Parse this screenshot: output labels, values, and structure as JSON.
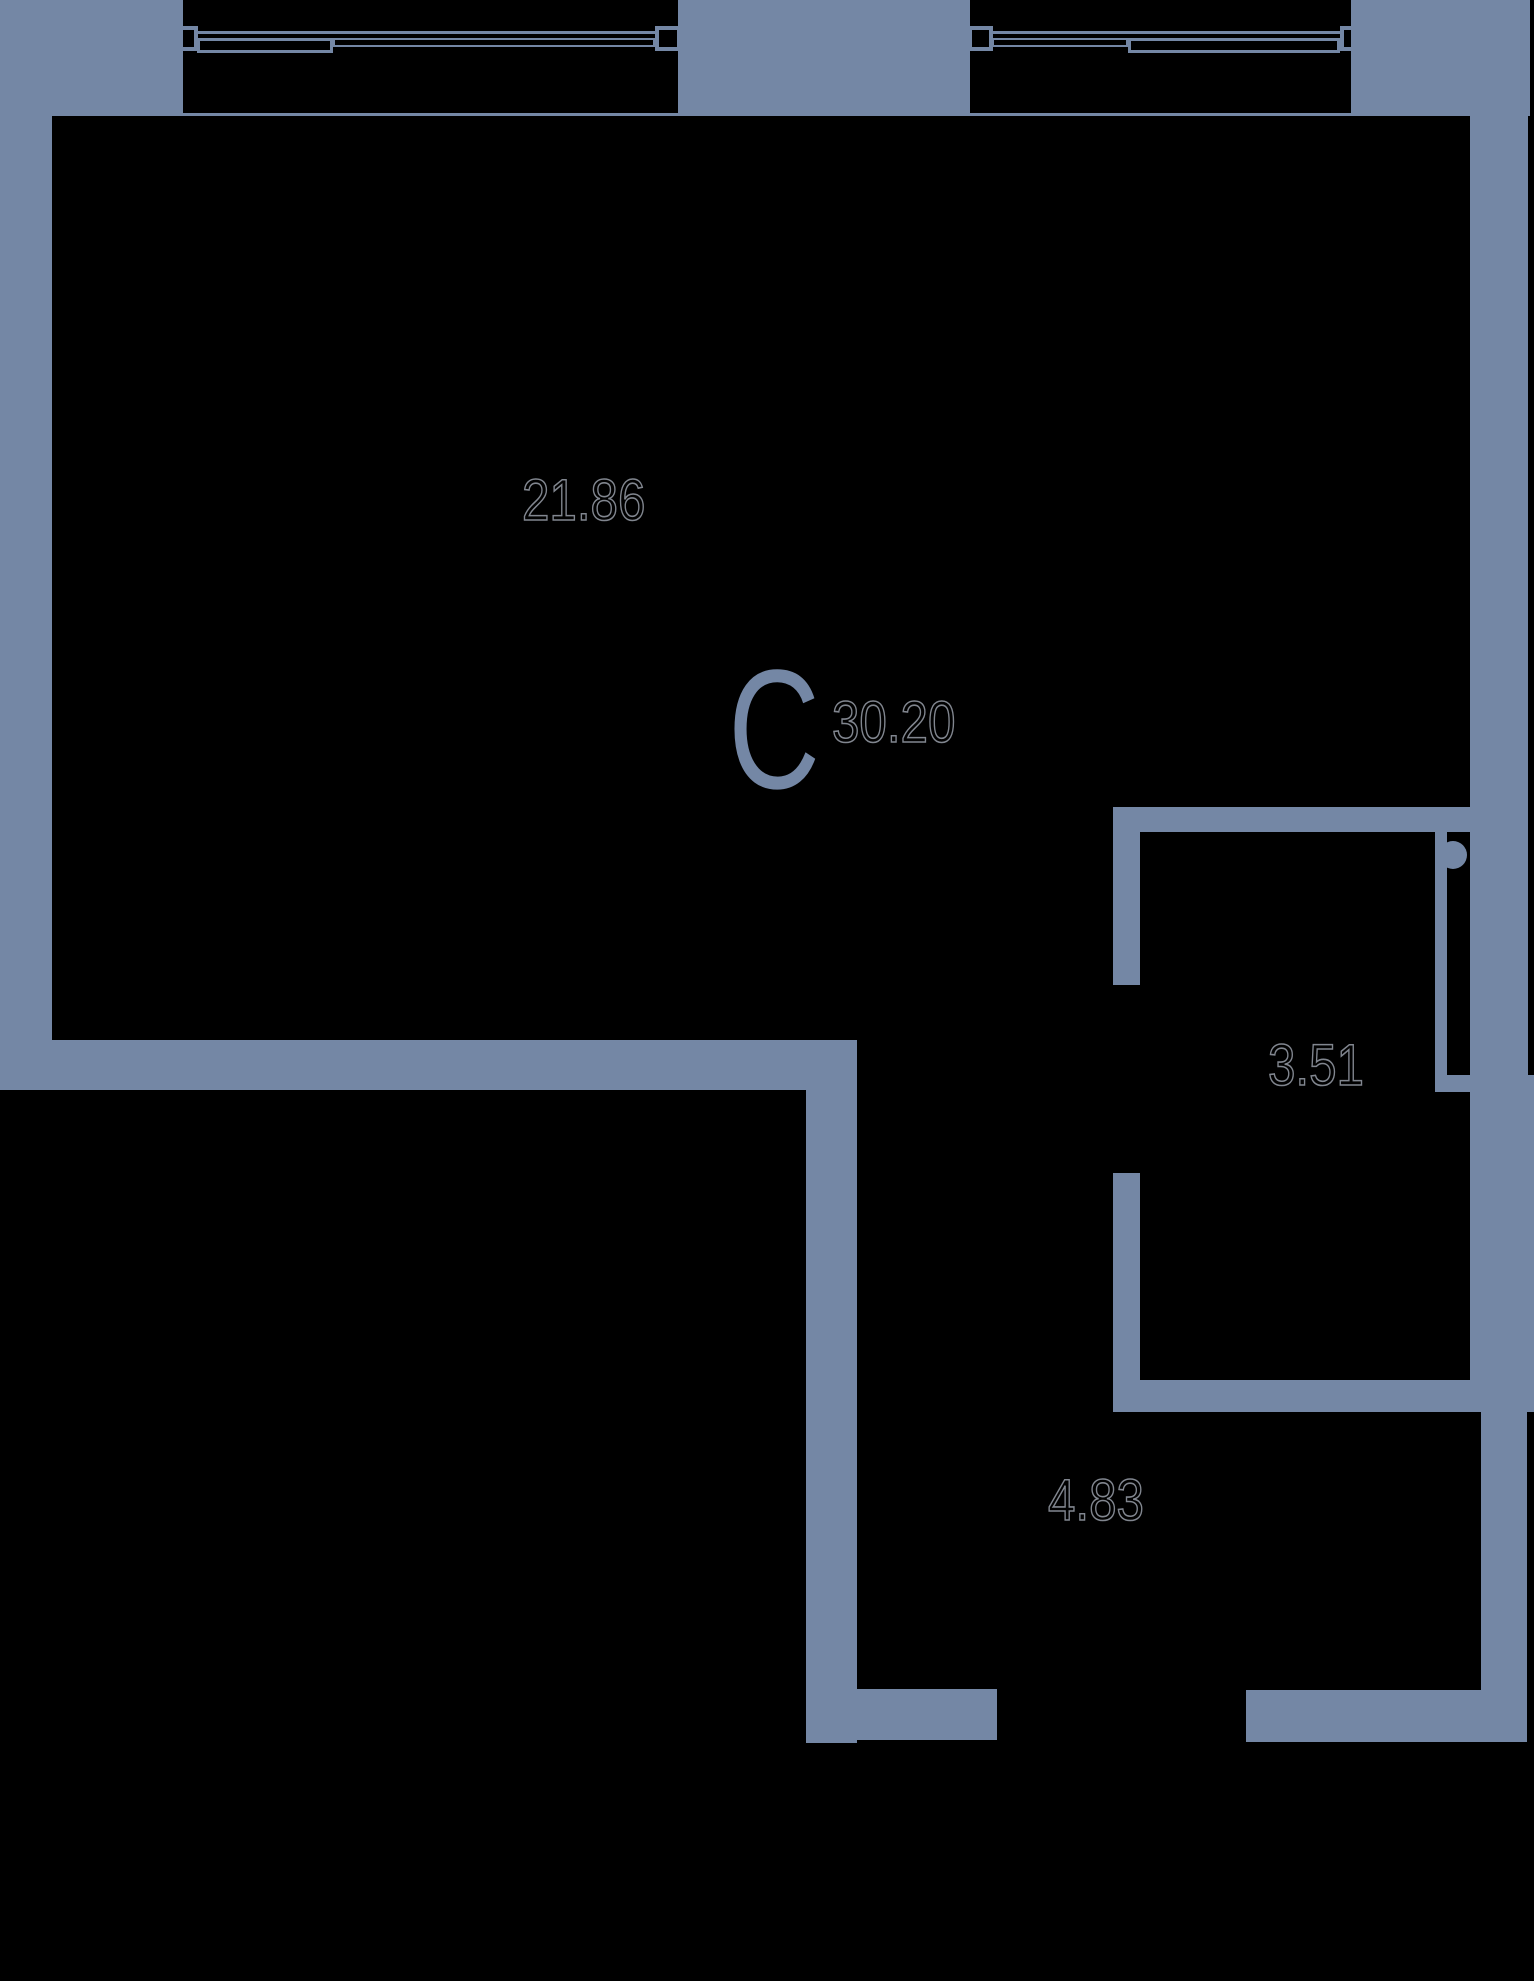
{
  "colors": {
    "wall": "#7487A5",
    "background": "#000000",
    "label_outline": "#81868F"
  },
  "compass": {
    "letter": "C"
  },
  "labels": {
    "living_area": "21.86",
    "total_area": "30.20",
    "bathroom_area": "3.51",
    "hall_area": "4.83"
  }
}
